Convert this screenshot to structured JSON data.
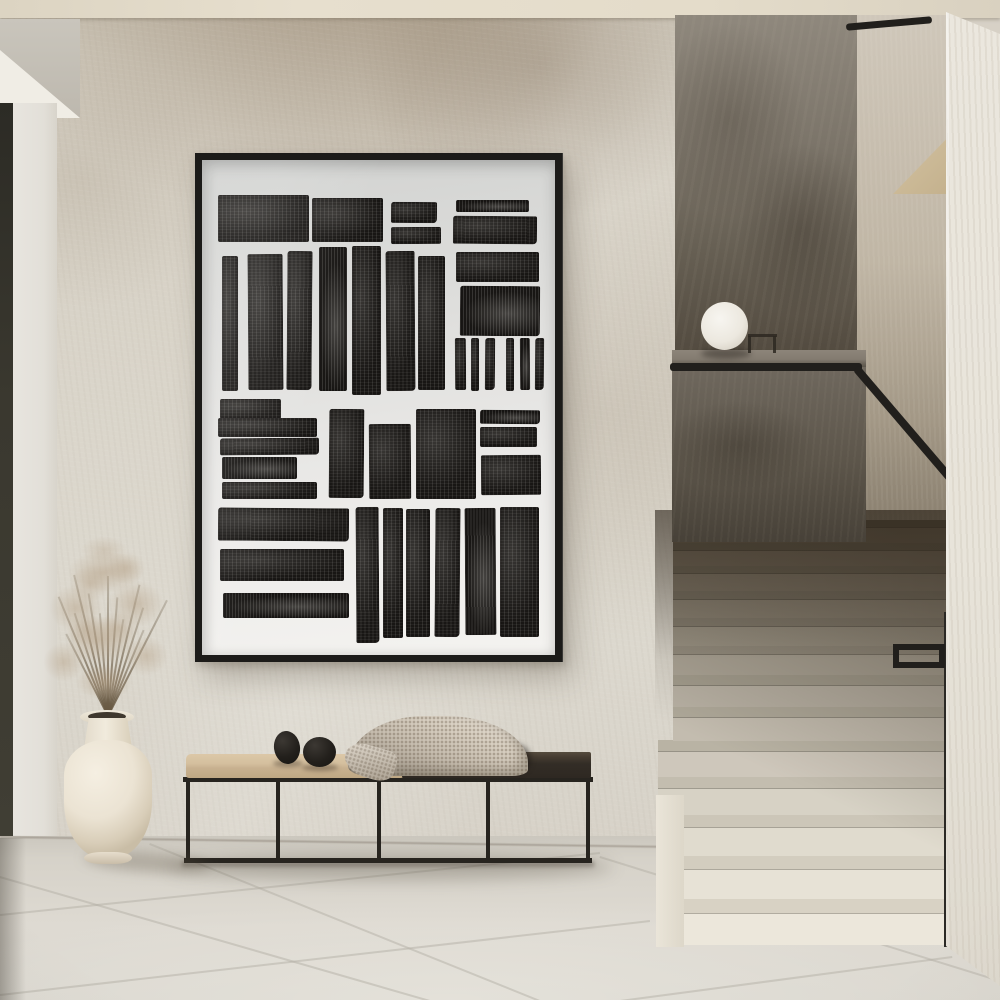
{
  "meta": {
    "description": "Minimalist hallway interior: black-framed abstract block-print artwork on textured plaster wall, black metal bench with beige cushion, knit throw and two black pebble objects, cream vase with dried pampas grass, terrazzo staircase with black handrail and white sphere lamp on the half-wall ledge",
    "width_px": 1000,
    "height_px": 1000
  },
  "palette": {
    "wall_base": "#d7d1c6",
    "soffit_under": "#f0ede5",
    "floor_joint": "#b4b0a5",
    "frame_black": "#1c1b19",
    "ink": "#181614",
    "handrail": "#211f1c",
    "rail_post": "#2b2925",
    "bench_frame": "#27241f",
    "blanket": "#d8cfc1",
    "plume_rgb": "178,156,128",
    "stem_rgb": "105,90,68",
    "riser_bright": "#ece7db",
    "tread_bright": "#d8d2c4",
    "riser_dark": "#665c4c",
    "tread_dark": "#4f4839"
  },
  "artwork": {
    "blocks": [
      [
        4.5,
        7.0,
        25.8,
        9.6
      ],
      [
        31.2,
        7.6,
        20.2,
        9.0
      ],
      [
        53.4,
        8.4,
        12.9,
        4.2
      ],
      [
        53.4,
        13.6,
        14.3,
        3.4
      ],
      [
        71.9,
        8.0,
        20.8,
        2.6
      ],
      [
        71.1,
        11.4,
        23.9,
        5.6
      ],
      [
        5.6,
        19.4,
        4.5,
        27.2
      ],
      [
        12.9,
        19.0,
        9.8,
        27.4
      ],
      [
        24.2,
        18.4,
        7.0,
        28.0
      ],
      [
        33.1,
        17.6,
        7.9,
        29.0
      ],
      [
        42.4,
        17.4,
        8.4,
        30.0
      ],
      [
        52.2,
        18.4,
        8.1,
        28.2
      ],
      [
        61.2,
        19.4,
        7.6,
        27.0
      ],
      [
        71.9,
        18.6,
        23.6,
        6.0
      ],
      [
        73.0,
        25.4,
        22.8,
        10.0
      ],
      [
        71.6,
        36.0,
        3.1,
        10.6
      ],
      [
        76.1,
        36.0,
        2.5,
        10.6
      ],
      [
        80.1,
        36.0,
        2.8,
        10.6
      ],
      [
        86.0,
        36.0,
        2.5,
        10.6
      ],
      [
        90.2,
        36.0,
        2.8,
        10.6
      ],
      [
        94.4,
        36.0,
        2.5,
        10.6
      ],
      [
        5.1,
        48.2,
        17.4,
        4.2
      ],
      [
        4.5,
        52.2,
        28.1,
        3.8
      ],
      [
        5.1,
        56.2,
        28.1,
        3.4
      ],
      [
        5.6,
        60.0,
        21.3,
        4.4
      ],
      [
        5.6,
        65.0,
        27.0,
        3.4
      ],
      [
        36.0,
        50.4,
        9.8,
        18.0
      ],
      [
        47.2,
        53.4,
        11.8,
        15.2
      ],
      [
        60.7,
        50.4,
        16.9,
        18.0
      ],
      [
        78.7,
        50.6,
        16.9,
        2.8
      ],
      [
        78.7,
        54.0,
        16.3,
        4.0
      ],
      [
        78.9,
        59.6,
        16.9,
        8.0
      ],
      [
        4.5,
        70.4,
        37.1,
        6.6
      ],
      [
        5.1,
        78.6,
        35.1,
        6.4
      ],
      [
        5.9,
        87.4,
        35.7,
        5.2
      ],
      [
        43.5,
        70.0,
        6.5,
        27.4
      ],
      [
        51.4,
        70.4,
        5.6,
        26.2
      ],
      [
        57.9,
        70.6,
        6.7,
        25.8
      ],
      [
        66.0,
        70.4,
        7.0,
        26.0
      ],
      [
        74.4,
        70.4,
        8.7,
        25.6
      ],
      [
        84.3,
        70.0,
        11.2,
        26.4
      ]
    ]
  },
  "stairs": {
    "count": 13,
    "container_bottom": 934,
    "base_step_h": 46,
    "ratio": 0.94,
    "riser_frac": 0.68,
    "left_lower": 5,
    "left_upper": 20,
    "right": 297,
    "lower_steps_protruding": 5
  },
  "floor_joints": [
    [
      0,
      914,
      600,
      852
    ],
    [
      0,
      994,
      650,
      920
    ],
    [
      620,
      1000,
      952,
      956
    ],
    [
      0,
      876,
      430,
      1000
    ],
    [
      150,
      843,
      540,
      1000
    ],
    [
      600,
      856,
      1000,
      980
    ]
  ],
  "plant": {
    "stems": {
      "count": 13,
      "base_x": 107,
      "base_y": 716,
      "min_len": 92,
      "max_len": 150,
      "spread_deg": 54
    },
    "plumes": [
      [
        105,
        572,
        104,
        58,
        0.5
      ],
      [
        76,
        608,
        74,
        66,
        0.46
      ],
      [
        136,
        604,
        78,
        64,
        0.46
      ],
      [
        100,
        640,
        96,
        66,
        0.52
      ],
      [
        64,
        662,
        58,
        54,
        0.42
      ],
      [
        146,
        656,
        62,
        54,
        0.42
      ],
      [
        104,
        682,
        78,
        50,
        0.5
      ],
      [
        90,
        584,
        58,
        50,
        0.38
      ],
      [
        126,
        568,
        54,
        46,
        0.38
      ],
      [
        104,
        550,
        64,
        38,
        0.32
      ],
      [
        118,
        628,
        60,
        48,
        0.4
      ],
      [
        86,
        630,
        56,
        46,
        0.4
      ]
    ]
  },
  "bench": {
    "legs_x_rel": [
      11,
      101,
      202,
      311,
      411
    ],
    "pebbles": [
      {
        "x": 99,
        "y": 31,
        "w": 26,
        "h": 33,
        "rot": -8
      },
      {
        "x": 128,
        "y": 37,
        "w": 33,
        "h": 30,
        "rot": 0
      }
    ],
    "pebble_shadows": [
      {
        "x": 98,
        "y": 60,
        "w": 30,
        "h": 7
      },
      {
        "x": 127,
        "y": 64,
        "w": 36,
        "h": 7
      }
    ]
  }
}
